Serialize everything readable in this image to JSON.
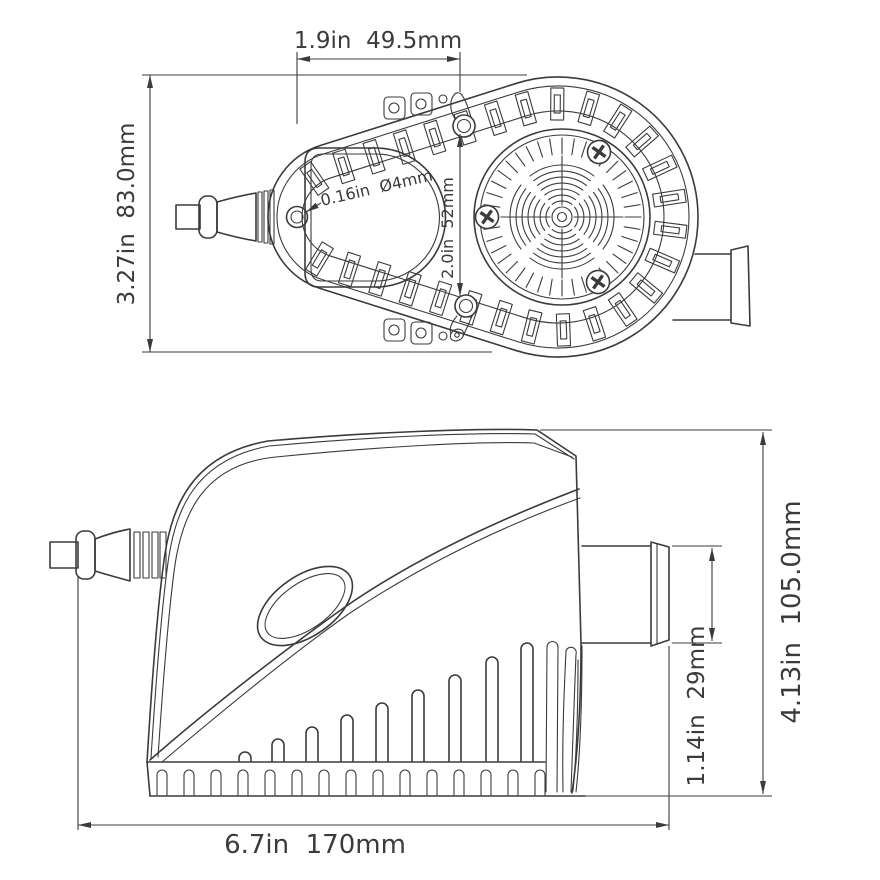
{
  "colors": {
    "line": "#3b3b3b",
    "background": "#ffffff"
  },
  "top_view": {
    "width_dim": "1.9in  49.5mm",
    "height_dim": "3.27in  83.0mm",
    "hole_dim": "0.16in  Ø4mm",
    "hole_spacing_dim": "2.0in  52mm"
  },
  "side_view": {
    "height_dim": "4.13in  105.0mm",
    "outlet_dim": "1.14in  29mm",
    "length_dim": "6.7in  170mm"
  }
}
